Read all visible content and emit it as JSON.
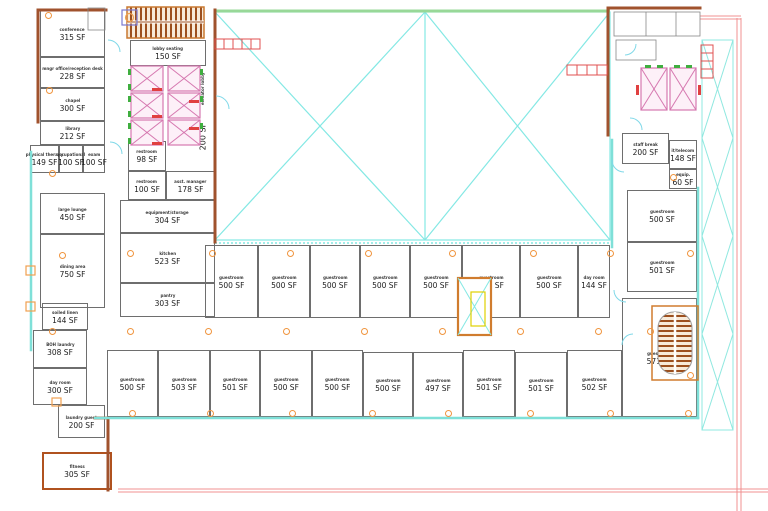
{
  "drawing": {
    "kind": "architectural floor plan",
    "palette": {
      "wall_brown": "#a0522d",
      "wall_orange": "#d07c2e",
      "wall_teal": "#7fe0d8",
      "atrium_cyan": "#84e8e4",
      "atrium_green": "#98d898",
      "elevator_pink": "#d678b0",
      "exit_red": "#e04040",
      "property_pink": "#f09090",
      "column_orange": "#f0953f",
      "room_line": "#6e6e6e",
      "stair_tread": "#9c4f1e"
    }
  },
  "rooms": [
    {
      "name": "conference",
      "area": "315 SF",
      "x": 40,
      "y": 10,
      "w": 65,
      "h": 47
    },
    {
      "name": "mngr office/reception desk",
      "area": "228 SF",
      "x": 40,
      "y": 57,
      "w": 65,
      "h": 31
    },
    {
      "name": "chapel",
      "area": "300 SF",
      "x": 40,
      "y": 88,
      "w": 65,
      "h": 33
    },
    {
      "name": "library",
      "area": "212 SF",
      "x": 40,
      "y": 121,
      "w": 65,
      "h": 24
    },
    {
      "name": "physical therapy",
      "area": "149 SF",
      "x": 30,
      "y": 145,
      "w": 29,
      "h": 28
    },
    {
      "name": "occupational",
      "area": "100 SF",
      "x": 59,
      "y": 145,
      "w": 24,
      "h": 28
    },
    {
      "name": "exam",
      "area": "100 SF",
      "x": 83,
      "y": 145,
      "w": 22,
      "h": 28
    },
    {
      "name": "large lounge",
      "area": "450 SF",
      "x": 40,
      "y": 193,
      "w": 65,
      "h": 41
    },
    {
      "name": "dining area",
      "area": "750 SF",
      "x": 40,
      "y": 234,
      "w": 65,
      "h": 74
    },
    {
      "name": "soiled linen",
      "area": "144 SF",
      "x": 42,
      "y": 303,
      "w": 46,
      "h": 27
    },
    {
      "name": "BOH laundry",
      "area": "308 SF",
      "x": 33,
      "y": 330,
      "w": 54,
      "h": 38
    },
    {
      "name": "day room",
      "area": "300 SF",
      "x": 33,
      "y": 368,
      "w": 54,
      "h": 37
    },
    {
      "name": "laundry guest",
      "area": "200 SF",
      "x": 58,
      "y": 405,
      "w": 47,
      "h": 33
    },
    {
      "name": "fitness",
      "area": "305 SF",
      "x": 42,
      "y": 452,
      "w": 70,
      "h": 38,
      "heavy": true
    },
    {
      "name": "lobby seating",
      "area": "150 SF",
      "x": 130,
      "y": 40,
      "w": 76,
      "h": 26
    },
    {
      "name": "elevator lobby",
      "area": "200 SF",
      "x": 190,
      "y": 62,
      "w": 26,
      "h": 83,
      "v": true,
      "noborder": true
    },
    {
      "name": "restroom",
      "area": "98 SF",
      "x": 128,
      "y": 141,
      "w": 38,
      "h": 30
    },
    {
      "name": "restroom",
      "area": "100 SF",
      "x": 128,
      "y": 171,
      "w": 38,
      "h": 29
    },
    {
      "name": "asst. manager",
      "area": "178 SF",
      "x": 166,
      "y": 171,
      "w": 49,
      "h": 29
    },
    {
      "name": "equipment/storage",
      "area": "304 SF",
      "x": 120,
      "y": 200,
      "w": 95,
      "h": 33
    },
    {
      "name": "kitchen",
      "area": "523 SF",
      "x": 120,
      "y": 233,
      "w": 95,
      "h": 50
    },
    {
      "name": "pantry",
      "area": "303 SF",
      "x": 120,
      "y": 283,
      "w": 95,
      "h": 34
    },
    {
      "name": "guestroom",
      "area": "500 SF",
      "x": 205,
      "y": 245,
      "w": 53,
      "h": 73
    },
    {
      "name": "guestroom",
      "area": "500 SF",
      "x": 258,
      "y": 245,
      "w": 52,
      "h": 73
    },
    {
      "name": "guestroom",
      "area": "500 SF",
      "x": 310,
      "y": 245,
      "w": 50,
      "h": 73
    },
    {
      "name": "guestroom",
      "area": "500 SF",
      "x": 360,
      "y": 245,
      "w": 50,
      "h": 73
    },
    {
      "name": "guestroom",
      "area": "500 SF",
      "x": 410,
      "y": 245,
      "w": 52,
      "h": 73
    },
    {
      "name": "guestroom",
      "area": "500 SF",
      "x": 462,
      "y": 245,
      "w": 58,
      "h": 73
    },
    {
      "name": "guestroom",
      "area": "500 SF",
      "x": 520,
      "y": 245,
      "w": 58,
      "h": 73
    },
    {
      "name": "day room",
      "area": "144 SF",
      "x": 578,
      "y": 245,
      "w": 32,
      "h": 73
    },
    {
      "name": "staff break",
      "area": "200 SF",
      "x": 622,
      "y": 133,
      "w": 47,
      "h": 31
    },
    {
      "name": "it/telecom",
      "area": "148 SF",
      "x": 669,
      "y": 140,
      "w": 28,
      "h": 29
    },
    {
      "name": "equip.",
      "area": "60 SF",
      "x": 669,
      "y": 169,
      "w": 28,
      "h": 20
    },
    {
      "name": "guestroom",
      "area": "500 SF",
      "x": 627,
      "y": 190,
      "w": 70,
      "h": 52
    },
    {
      "name": "guestroom",
      "area": "501 SF",
      "x": 627,
      "y": 242,
      "w": 70,
      "h": 50
    },
    {
      "name": "guestroom",
      "area": "500 SF",
      "x": 107,
      "y": 350,
      "w": 51,
      "h": 67
    },
    {
      "name": "guestroom",
      "area": "503 SF",
      "x": 158,
      "y": 350,
      "w": 52,
      "h": 67
    },
    {
      "name": "guestroom",
      "area": "501 SF",
      "x": 210,
      "y": 350,
      "w": 50,
      "h": 67
    },
    {
      "name": "guestroom",
      "area": "500 SF",
      "x": 260,
      "y": 350,
      "w": 52,
      "h": 67
    },
    {
      "name": "guestroom",
      "area": "500 SF",
      "x": 312,
      "y": 350,
      "w": 51,
      "h": 67
    },
    {
      "name": "guestroom",
      "area": "500 SF",
      "x": 363,
      "y": 352,
      "w": 50,
      "h": 65
    },
    {
      "name": "guestroom",
      "area": "497 SF",
      "x": 413,
      "y": 352,
      "w": 50,
      "h": 66
    },
    {
      "name": "guestroom",
      "area": "501 SF",
      "x": 463,
      "y": 350,
      "w": 52,
      "h": 67
    },
    {
      "name": "guestroom",
      "area": "501 SF",
      "x": 515,
      "y": 352,
      "w": 52,
      "h": 66
    },
    {
      "name": "guestroom",
      "area": "502 SF",
      "x": 567,
      "y": 350,
      "w": 55,
      "h": 67
    },
    {
      "name": "guestroom",
      "area": "571 SF",
      "x": 622,
      "y": 298,
      "w": 75,
      "h": 119
    }
  ],
  "column_markers": [
    [
      48,
      15
    ],
    [
      49,
      90
    ],
    [
      52,
      173
    ],
    [
      62,
      255
    ],
    [
      130,
      253
    ],
    [
      212,
      253
    ],
    [
      290,
      253
    ],
    [
      368,
      253
    ],
    [
      452,
      253
    ],
    [
      533,
      253
    ],
    [
      610,
      253
    ],
    [
      52,
      331
    ],
    [
      130,
      331
    ],
    [
      208,
      331
    ],
    [
      286,
      331
    ],
    [
      364,
      331
    ],
    [
      442,
      331
    ],
    [
      520,
      331
    ],
    [
      598,
      331
    ],
    [
      650,
      331
    ],
    [
      132,
      413
    ],
    [
      210,
      413
    ],
    [
      292,
      413
    ],
    [
      372,
      413
    ],
    [
      448,
      413
    ],
    [
      530,
      413
    ],
    [
      610,
      413
    ],
    [
      688,
      413
    ],
    [
      690,
      253
    ],
    [
      673,
      177
    ],
    [
      690,
      375
    ]
  ]
}
